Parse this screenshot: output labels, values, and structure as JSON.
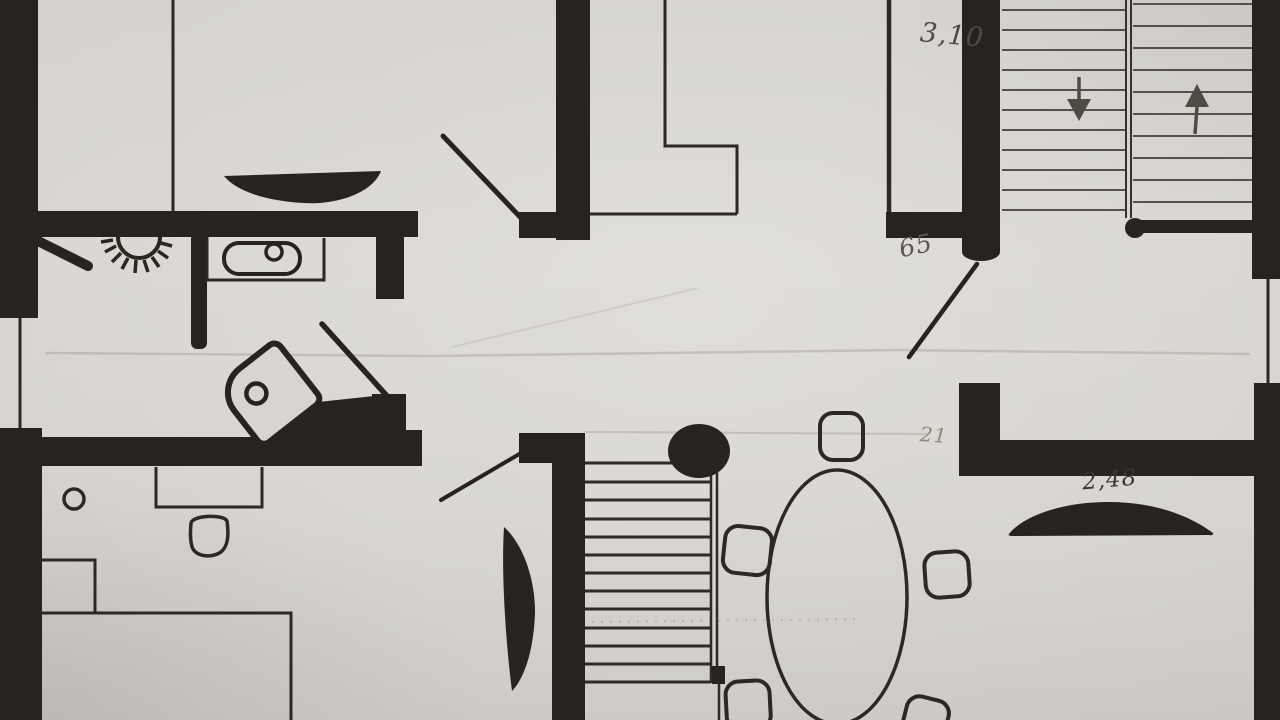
{
  "annotations": {
    "stairwell_width": "3,10",
    "door_width": "65",
    "wall_thickness": "21",
    "sideboard_length": "2,48"
  },
  "colors": {
    "paper": "#d6d3ce",
    "ink": "#28231e",
    "pencil": "#4e4a44",
    "pencil_faint": "#a9a49b"
  }
}
